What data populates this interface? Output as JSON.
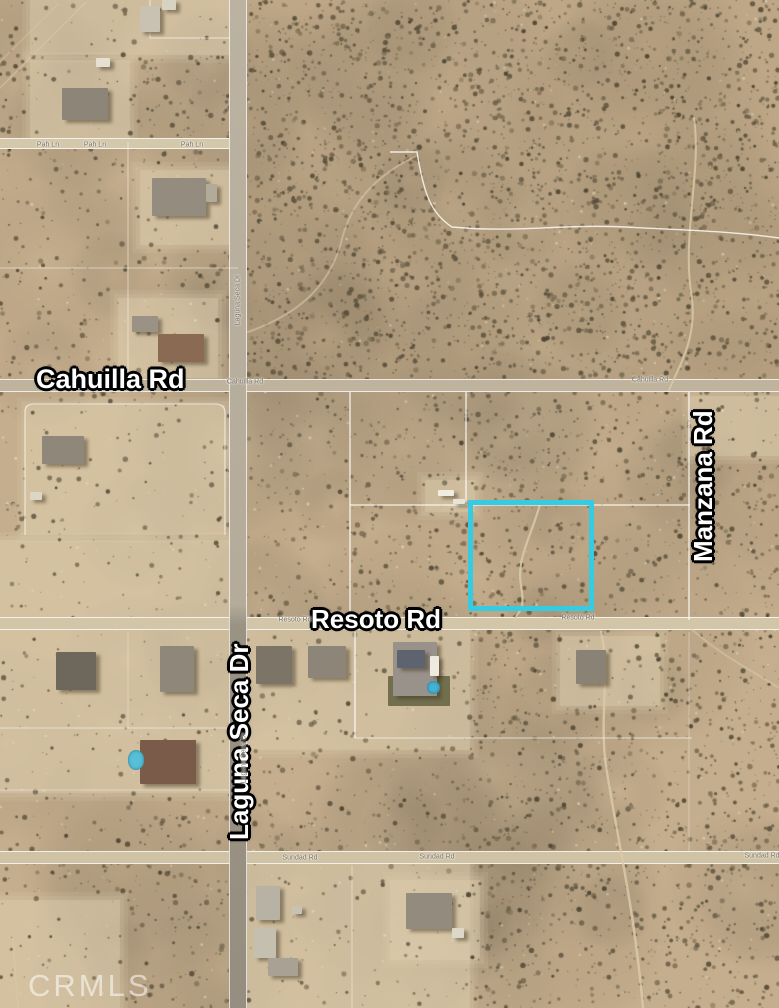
{
  "map": {
    "watermark": "CRMLS",
    "highlight_color": "#35cbe3",
    "major_road_labels": {
      "cahuilla": "Cahuilla Rd",
      "resoto": "Resoto Rd",
      "manzana": "Manzana Rd",
      "laguna_seca": "Laguna Seca Dr"
    },
    "tiny_road_labels": [
      {
        "text": "Cahuilla Rd",
        "x": 245,
        "y": 382,
        "rot": 0
      },
      {
        "text": "Cahuilla Rd",
        "x": 650,
        "y": 380,
        "rot": 0
      },
      {
        "text": "Resoto Rd",
        "x": 295,
        "y": 620,
        "rot": 0
      },
      {
        "text": "Resoto Rd",
        "x": 578,
        "y": 618,
        "rot": 0
      },
      {
        "text": "Sundad Rd",
        "x": 300,
        "y": 858,
        "rot": 0
      },
      {
        "text": "Sundad Rd",
        "x": 437,
        "y": 857,
        "rot": 0
      },
      {
        "text": "Sundad Rd",
        "x": 762,
        "y": 856,
        "rot": 0
      },
      {
        "text": "Pah Ln",
        "x": 48,
        "y": 145,
        "rot": 0
      },
      {
        "text": "Pah Ln",
        "x": 95,
        "y": 145,
        "rot": 0
      },
      {
        "text": "Pah Ln",
        "x": 192,
        "y": 145,
        "rot": 0
      },
      {
        "text": "Laguna Seca Dr",
        "x": 238,
        "y": 300,
        "rot": -90
      },
      {
        "text": "Laguna Seca Dr",
        "x": 244,
        "y": 758,
        "rot": -90
      }
    ]
  }
}
